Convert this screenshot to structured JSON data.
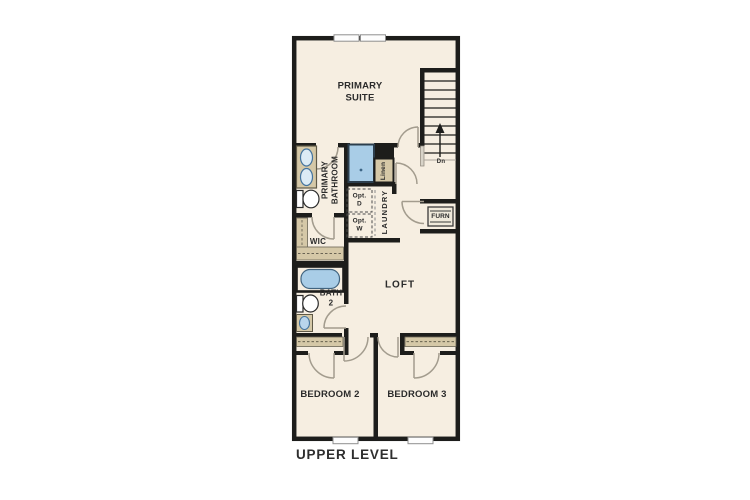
{
  "title": "UPPER LEVEL",
  "rooms": {
    "primary_suite": "PRIMARY SUITE",
    "primary_bathroom": "PRIMARY BATHROOM",
    "wic": "WIC",
    "bath_2": "BATH 2",
    "loft": "LOFT",
    "laundry": "LAUNDRY",
    "bedroom_2": "BEDROOM 2",
    "bedroom_3": "BEDROOM 3"
  },
  "annotations": {
    "linen": "Linen",
    "opt_dryer": "Opt. D",
    "opt_washer": "Opt. W",
    "furnace": "FURN",
    "stairs_direction": "Dn"
  },
  "colors": {
    "floor": "#f6eee1",
    "wall": "#1d1d1b",
    "casework": "#d5c8a7",
    "fixture_blue": "#a9cde7",
    "door_swing": "#a39c8e",
    "label_text": "#2b2b2b"
  }
}
